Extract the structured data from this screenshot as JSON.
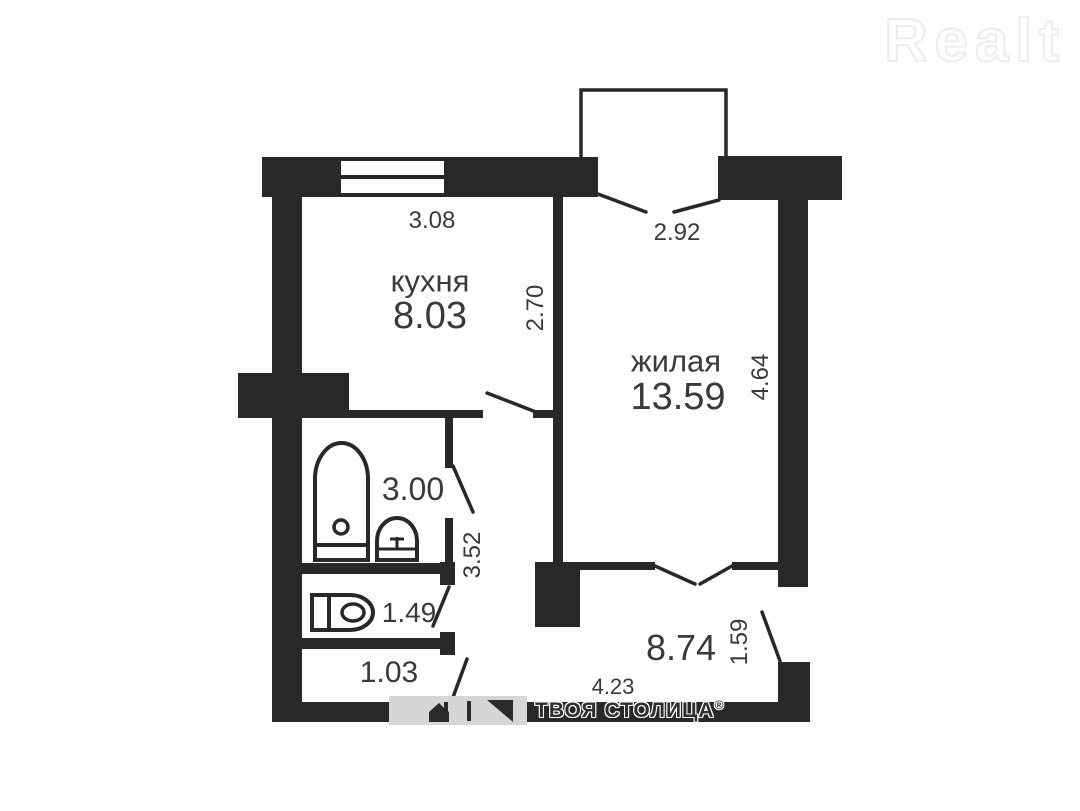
{
  "brand": {
    "logo": "Realt"
  },
  "floorplan": {
    "rooms": {
      "kitchen": {
        "name": "кухня",
        "area": "8.03"
      },
      "living": {
        "name": "жилая",
        "area": "13.59"
      },
      "bathroom": {
        "area": "3.00"
      },
      "toilet": {
        "width": "1.49"
      },
      "hallway": {
        "width": "1.03"
      },
      "corridor": {
        "area": "8.74"
      }
    },
    "dimensions": {
      "kitchen_top": "3.08",
      "balcony": "2.92",
      "kitchen_side": "2.70",
      "living_side": "4.64",
      "bathroom_side": "3.52",
      "corridor_bottom": "4.23",
      "entry_door": "1.59"
    }
  },
  "footer": {
    "agency": "ТВОЯ СТОЛИЦА",
    "reg": "®"
  },
  "colors": {
    "wall": "#282828",
    "label": "#3a3a3a",
    "logo_outline": "#ececec",
    "watermark_band": "#d6d6d6"
  }
}
